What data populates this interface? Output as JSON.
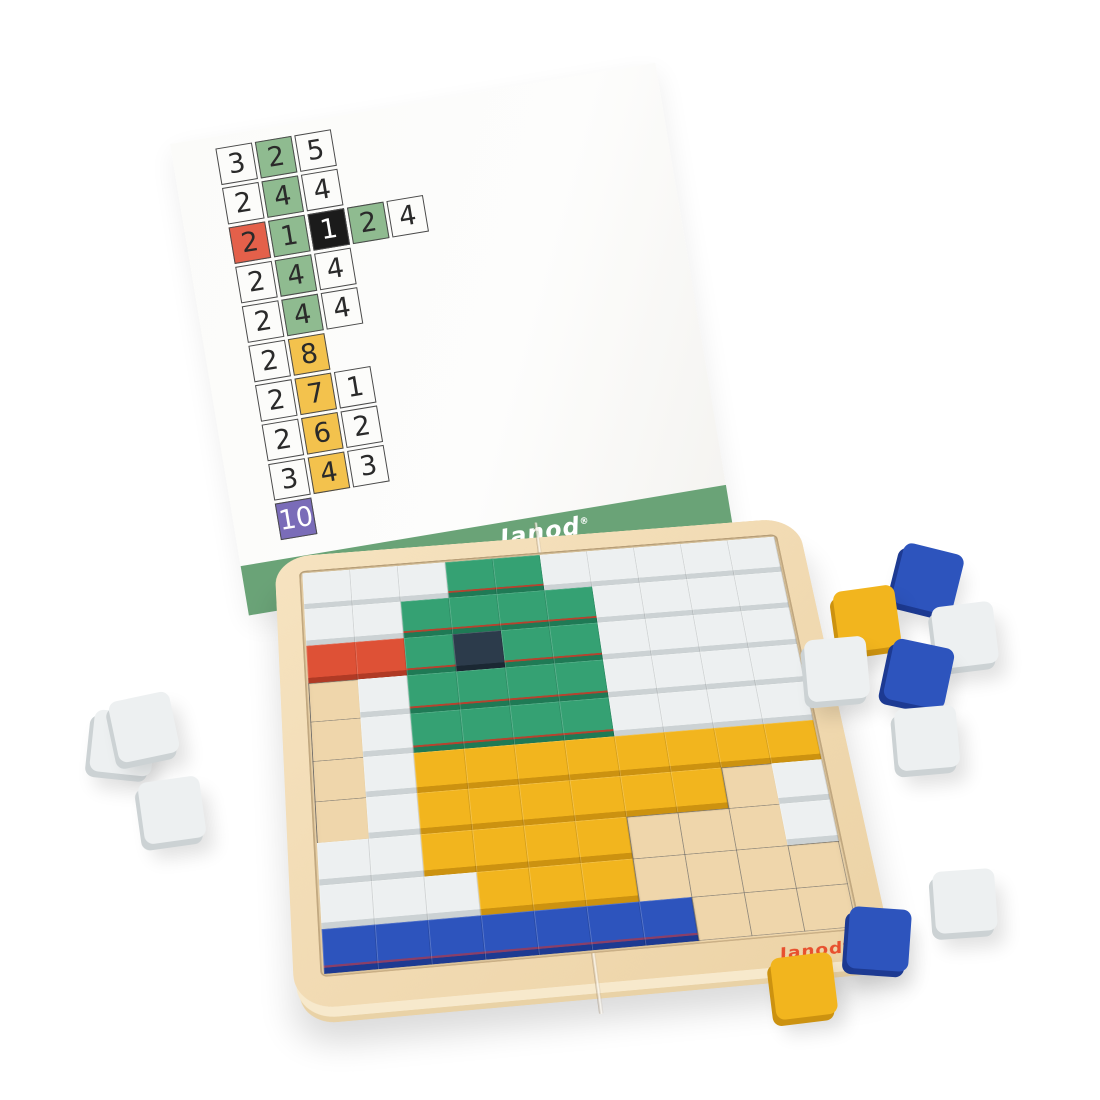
{
  "brand": {
    "card_logo": "Janod",
    "board_logo": "Janod",
    "registered_mark": "®",
    "card_logo_color": "#ffffff",
    "board_logo_color": "#e8502e"
  },
  "card": {
    "band_color": "#6aa377",
    "arrow_icon": "right-arrow",
    "cell_colors": {
      "white": {
        "bg": "#fcfcfa",
        "fg": "#2a2a2a"
      },
      "green": {
        "bg": "#8fbb90",
        "fg": "#2a2a2a"
      },
      "red": {
        "bg": "#e4604a",
        "fg": "#2a2a2a"
      },
      "black": {
        "bg": "#1b1b1b",
        "fg": "#ffffff"
      },
      "yellow": {
        "bg": "#f3c24d",
        "fg": "#2a2a2a"
      },
      "purple": {
        "bg": "#7a6cb8",
        "fg": "#ffffff"
      }
    },
    "rows": [
      [
        {
          "n": "3",
          "c": "white"
        },
        {
          "n": "2",
          "c": "green"
        },
        {
          "n": "5",
          "c": "white"
        }
      ],
      [
        {
          "n": "2",
          "c": "white"
        },
        {
          "n": "4",
          "c": "green"
        },
        {
          "n": "4",
          "c": "white"
        }
      ],
      [
        {
          "n": "2",
          "c": "red"
        },
        {
          "n": "1",
          "c": "green"
        },
        {
          "n": "1",
          "c": "black"
        },
        {
          "n": "2",
          "c": "green"
        },
        {
          "n": "4",
          "c": "white"
        }
      ],
      [
        {
          "n": "2",
          "c": "white"
        },
        {
          "n": "4",
          "c": "green"
        },
        {
          "n": "4",
          "c": "white"
        }
      ],
      [
        {
          "n": "2",
          "c": "white"
        },
        {
          "n": "4",
          "c": "green"
        },
        {
          "n": "4",
          "c": "white"
        }
      ],
      [
        {
          "n": "2",
          "c": "white"
        },
        {
          "n": "8",
          "c": "yellow"
        }
      ],
      [
        {
          "n": "2",
          "c": "white"
        },
        {
          "n": "7",
          "c": "yellow"
        },
        {
          "n": "1",
          "c": "white"
        }
      ],
      [
        {
          "n": "2",
          "c": "white"
        },
        {
          "n": "6",
          "c": "yellow"
        },
        {
          "n": "2",
          "c": "white"
        }
      ],
      [
        {
          "n": "3",
          "c": "white"
        },
        {
          "n": "4",
          "c": "yellow"
        },
        {
          "n": "3",
          "c": "white"
        }
      ],
      [
        {
          "n": "10",
          "c": "purple"
        }
      ]
    ]
  },
  "board": {
    "tile_palette": {
      "W": {
        "top": "#edf0f1",
        "side": "#ccd2d4"
      },
      "G": {
        "top": "#35a173",
        "side": "#1f7a55",
        "hint": "#b5432f"
      },
      "K": {
        "top": "#2c3b4b",
        "side": "#1b2833"
      },
      "R": {
        "top": "#de5136",
        "side": "#b03a25"
      },
      "Y": {
        "top": "#f2b51e",
        "side": "#cc9210"
      },
      "B": {
        "top": "#2d54bd",
        "side": "#1d3a92",
        "hint": "#8a3f68"
      }
    },
    "wood_color": "#f1dab2",
    "grid_rows": [
      "WWWGGWWWWW",
      "WWGGGGWWWW",
      "RRGKGGWWWW",
      ".WGGGGWWWW",
      ".WGGGGWWWW",
      ".WYYYYYYYY",
      ".WYYYYYY.W",
      "WWYYYY...W",
      "WWWYYY....",
      "BBBBBBB..."
    ]
  },
  "loose_tiles": [
    {
      "c": "B",
      "x": 897,
      "y": 548,
      "r": 14
    },
    {
      "c": "Y",
      "x": 836,
      "y": 588,
      "r": -8
    },
    {
      "c": "W",
      "x": 934,
      "y": 604,
      "r": -7
    },
    {
      "c": "W",
      "x": 806,
      "y": 638,
      "r": -5
    },
    {
      "c": "B",
      "x": 888,
      "y": 643,
      "r": 12
    },
    {
      "c": "W",
      "x": 896,
      "y": 707,
      "r": -5
    },
    {
      "c": "W",
      "x": 92,
      "y": 712,
      "r": 6
    },
    {
      "c": "W",
      "x": 113,
      "y": 696,
      "r": -12
    },
    {
      "c": "W",
      "x": 141,
      "y": 779,
      "r": -8
    },
    {
      "c": "W",
      "x": 934,
      "y": 870,
      "r": -4
    },
    {
      "c": "B",
      "x": 848,
      "y": 908,
      "r": 4
    },
    {
      "c": "Y",
      "x": 773,
      "y": 955,
      "r": -7
    }
  ]
}
